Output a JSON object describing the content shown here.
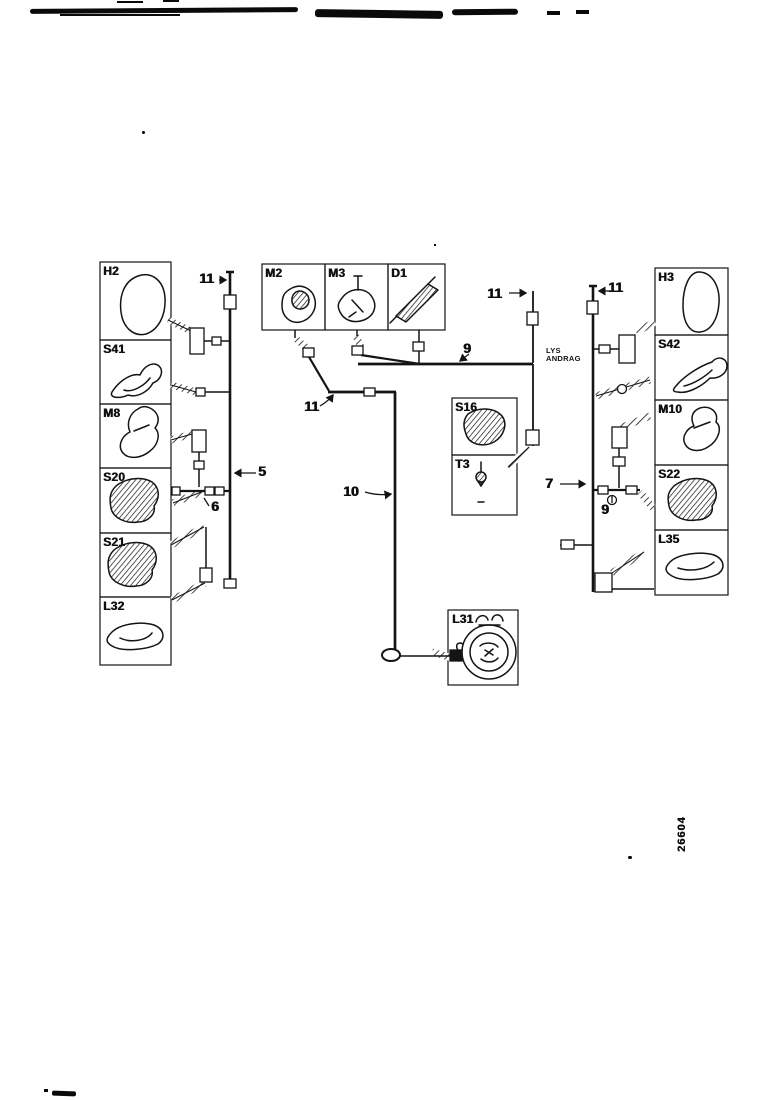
{
  "colors": {
    "ink": "#141414",
    "background": "#ffffff"
  },
  "components": {
    "h2": {
      "label": "H2"
    },
    "s41": {
      "label": "S41"
    },
    "m8": {
      "label": "M8"
    },
    "s20": {
      "label": "S20"
    },
    "s21": {
      "label": "S21"
    },
    "l32": {
      "label": "L32"
    },
    "m2": {
      "label": "M2"
    },
    "m3": {
      "label": "M3"
    },
    "d1": {
      "label": "D1"
    },
    "s16": {
      "label": "S16"
    },
    "t3": {
      "label": "T3"
    },
    "l31": {
      "label": "L31"
    },
    "h3": {
      "label": "H3"
    },
    "s42": {
      "label": "S42"
    },
    "m10": {
      "label": "M10"
    },
    "s22": {
      "label": "S22"
    },
    "l35": {
      "label": "L35"
    }
  },
  "callouts": {
    "left_bus_top": "11",
    "center_left": "11",
    "center_right": "11",
    "right_bus_top": "11",
    "bus_center": "9",
    "right_junction": "9",
    "left_bus_mid": "5",
    "left_junction": "6",
    "right_bus_mid": "7",
    "harness_drop": "10"
  },
  "annotation": {
    "line1": "LYS",
    "line2": "ANDRAG"
  },
  "part_number": "26604"
}
